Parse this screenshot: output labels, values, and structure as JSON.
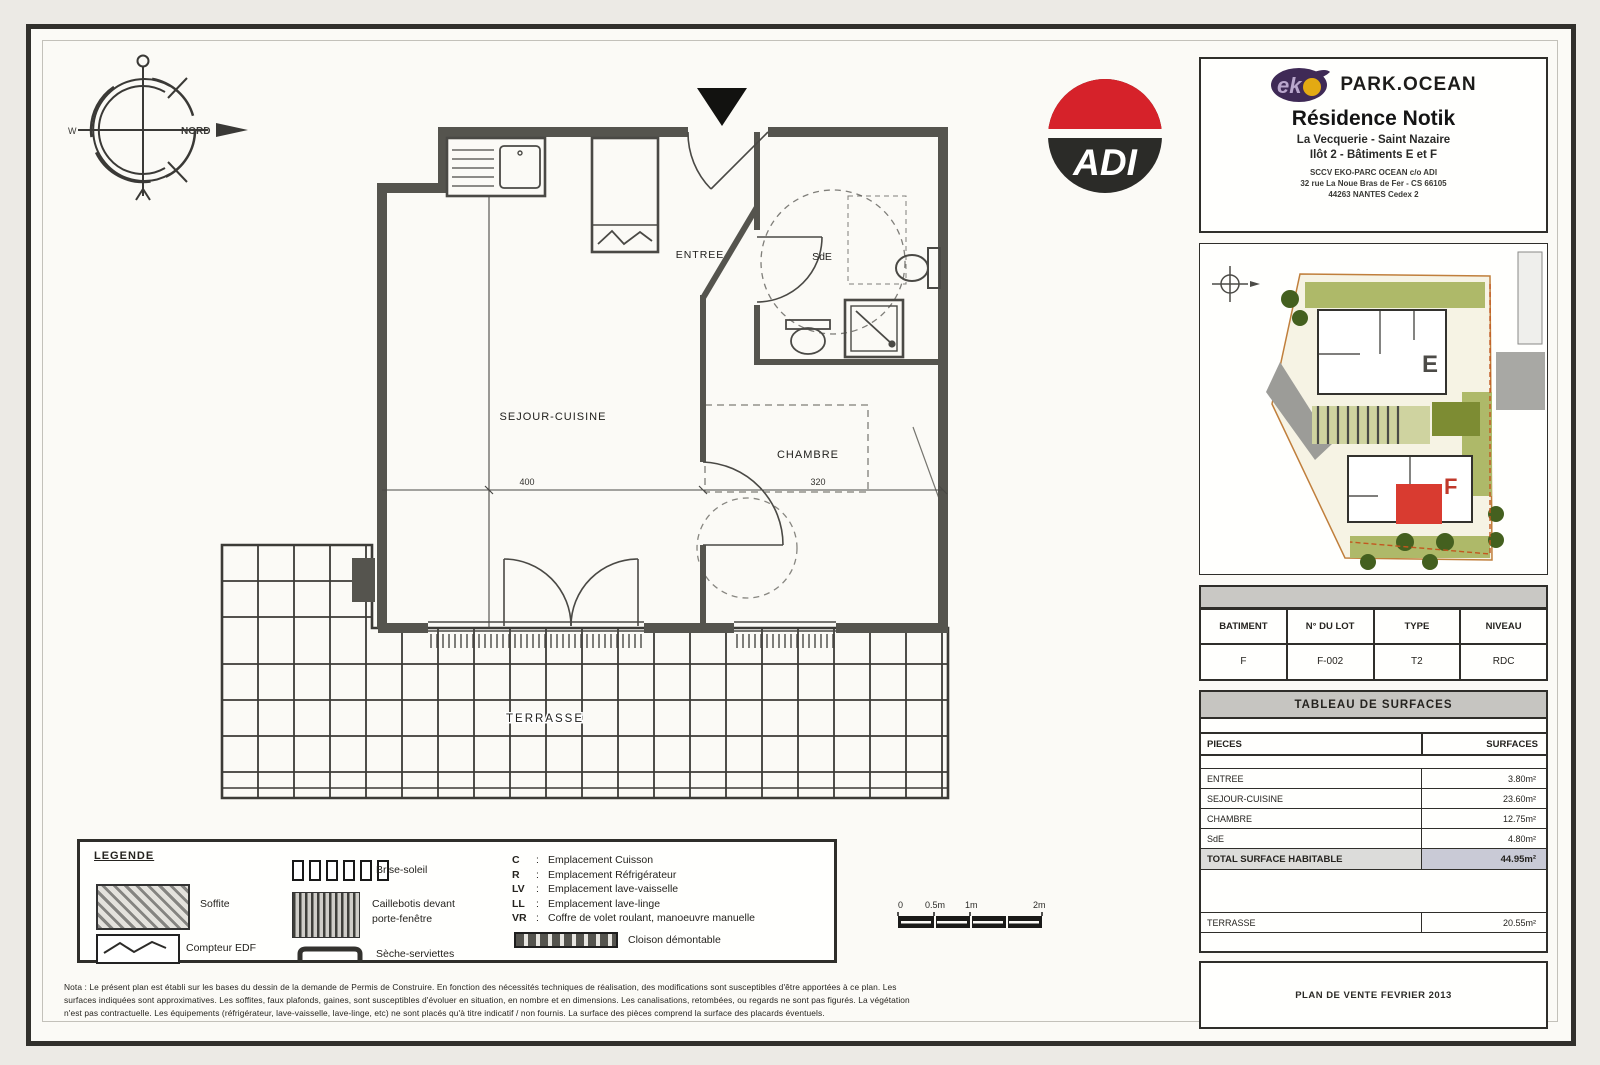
{
  "colors": {
    "accent_red": "#d6222a",
    "logo_dark": "#2b2b28",
    "logo_purple": "#3f2a56",
    "logo_gold": "#e3aa13",
    "wall_gray": "#55544e",
    "site_green": "#a9b257",
    "unit_red": "#d93b30"
  },
  "compass": {
    "north": "NORD",
    "west": "W"
  },
  "adi": {
    "label": "ADI"
  },
  "title_block": {
    "brand_letters": "ek",
    "project": "PARK.OCEAN",
    "residence": "Résidence Notik",
    "loc1": "La Vecquerie - Saint Nazaire",
    "loc2": "Ilôt 2 - Bâtiments E et F",
    "addr1": "SCCV EKO-PARC OCEAN c/o ADI",
    "addr2": "32 rue La Noue Bras de Fer - CS 66105",
    "addr3": "44263 NANTES Cedex 2"
  },
  "site_plan": {
    "building_e": "E",
    "building_f": "F"
  },
  "lot_table": {
    "headers": [
      "BATIMENT",
      "N° DU LOT",
      "TYPE",
      "NIVEAU"
    ],
    "values": [
      "F",
      "F-002",
      "T2",
      "RDC"
    ]
  },
  "surfaces": {
    "title": "TABLEAU DE SURFACES",
    "col_pieces": "PIECES",
    "col_surfaces": "SURFACES",
    "rows": [
      {
        "piece": "ENTREE",
        "value": "3.80m²"
      },
      {
        "piece": "SEJOUR-CUISINE",
        "value": "23.60m²"
      },
      {
        "piece": "CHAMBRE",
        "value": "12.75m²"
      },
      {
        "piece": "SdE",
        "value": "4.80m²"
      }
    ],
    "total_label": "TOTAL SURFACE HABITABLE",
    "total_value": "44.95m²",
    "terrasse_label": "TERRASSE",
    "terrasse_value": "20.55m²"
  },
  "stamp": "PLAN DE VENTE FEVRIER 2013",
  "plan": {
    "rooms": {
      "sejour": "SEJOUR-CUISINE",
      "entree": "ENTREE",
      "sde": "SdE",
      "chambre": "CHAMBRE",
      "terrasse": "TERRASSE"
    },
    "dims": {
      "sejour_width": "400",
      "chambre_width": "320"
    }
  },
  "legend": {
    "title": "LEGENDE",
    "sep": ":",
    "soffite": "Soffite",
    "compteur": "Compteur EDF",
    "brise": "Brise-soleil",
    "caillebotis_1": "Caillebotis devant",
    "caillebotis_2": "porte-fenêtre",
    "seche": "Sèche-serviettes",
    "abbrevs": [
      {
        "key": "C",
        "label": "Emplacement Cuisson"
      },
      {
        "key": "R",
        "label": "Emplacement Réfrigérateur"
      },
      {
        "key": "LV",
        "label": "Emplacement lave-vaisselle"
      },
      {
        "key": "LL",
        "label": "Emplacement lave-linge"
      },
      {
        "key": "VR",
        "label": "Coffre de volet roulant, manoeuvre manuelle"
      }
    ],
    "cloison": "Cloison démontable"
  },
  "scale_bar": {
    "labels": [
      "0",
      "0.5m",
      "1m",
      "2m"
    ]
  },
  "notes": {
    "line1": "Nota : Le présent plan est établi sur les bases du dessin de la demande de Permis de Construire. En fonction des nécessités techniques de réalisation, des modifications sont susceptibles d'être apportées à ce plan. Les",
    "line2": "surfaces indiquées sont approximatives. Les soffites, faux plafonds, gaines, sont susceptibles d'évoluer en situation, en nombre et en dimensions. Les canalisations, retombées, ou regards ne sont pas figurés. La végétation",
    "line3": "n'est pas contractuelle. Les équipements (réfrigérateur, lave-vaisselle, lave-linge, etc) ne sont placés qu'à titre indicatif / non fournis. La surface des pièces comprend la surface des placards éventuels."
  }
}
